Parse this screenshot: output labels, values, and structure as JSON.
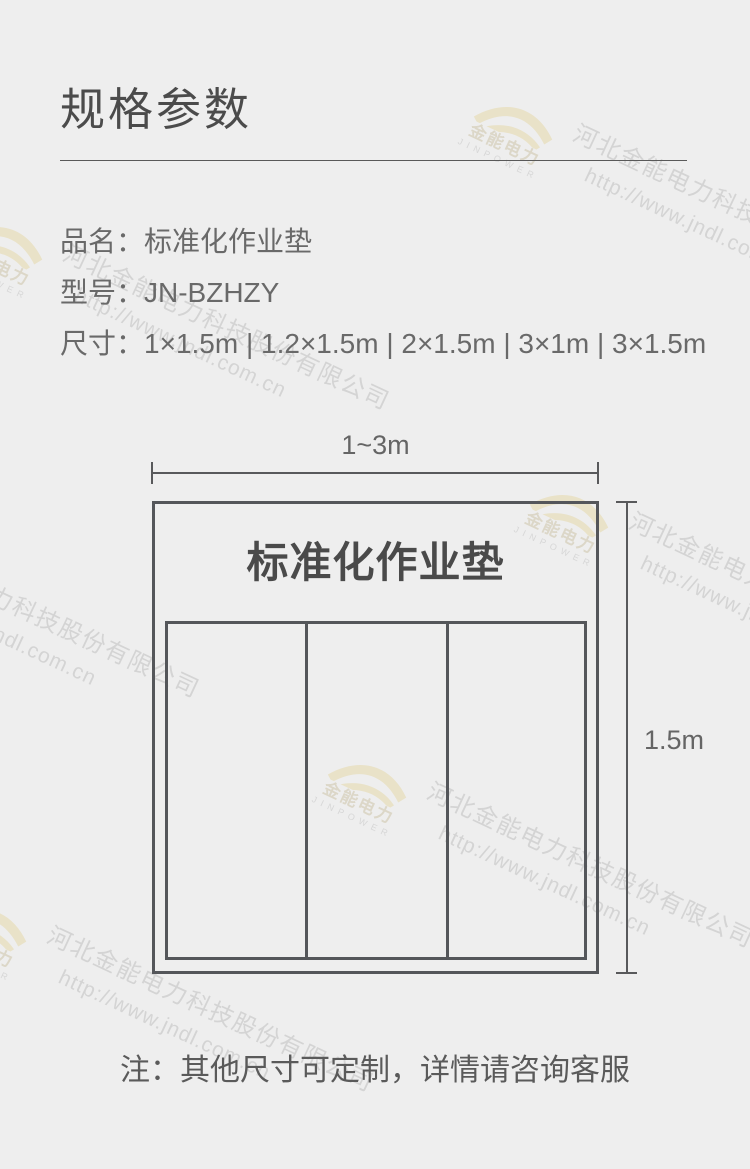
{
  "page": {
    "title": "规格参数",
    "background_color": "#eeeeee",
    "text_dark_color": "#4b4b4b",
    "diagram_line_color": "#54565a"
  },
  "product": {
    "rows": [
      {
        "label": "品名：",
        "value": "标准化作业垫"
      },
      {
        "label": "型号：",
        "value": "JN-BZHZY"
      },
      {
        "label": "尺寸：",
        "value": "1×1.5m | 1.2×1.5m | 2×1.5m | 3×1m | 3×1.5m"
      }
    ]
  },
  "diagram": {
    "width_label": "1~3m",
    "height_label": "1.5m",
    "mat_title": "标准化作业垫",
    "sections": 3
  },
  "note": "注：其他尺寸可定制，详情请咨询客服",
  "watermark": {
    "company": "河北金能电力科技股份有限公司",
    "url": "http://www.jndl.com.cn",
    "logo_cn": "金能电力",
    "logo_en": "JINPOWER",
    "text_color": "#d4d4d4",
    "logo_arc_color": "#e9e2c8"
  }
}
